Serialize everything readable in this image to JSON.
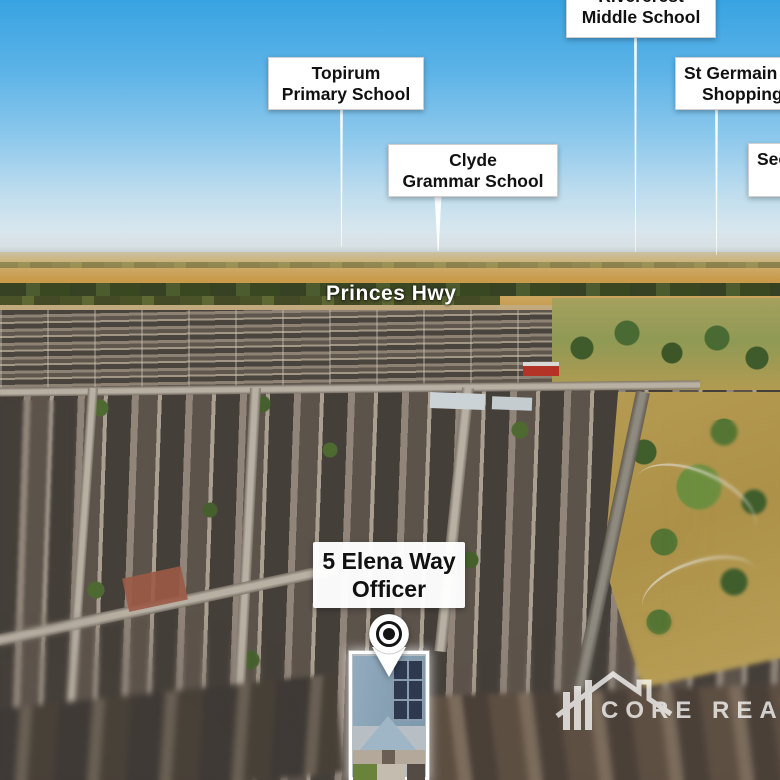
{
  "road_label": "Princes Hwy",
  "poi_labels": {
    "rivercrest": {
      "lines": [
        "Rivercrest",
        "Middle School"
      ]
    },
    "topirum": {
      "lines": [
        "Topirum",
        "Primary School"
      ]
    },
    "clyde": {
      "lines": [
        "Clyde",
        "Grammar School"
      ]
    },
    "st_germain": {
      "lines": [
        "St Germain",
        "Shopping"
      ]
    },
    "secondary": {
      "lines": [
        "Sec"
      ]
    }
  },
  "property_label": {
    "lines": [
      "5 Elena Way",
      "Officer"
    ]
  },
  "watermark": {
    "text": "CORE REAL"
  },
  "icons": {
    "map_pin": "teardrop-location-pin",
    "watermark_house": "house-roofline-with-bars"
  },
  "palette": {
    "sky_top": "#38a3e2",
    "sky_horizon": "#d8e4ea",
    "field_gold": "#c6973f",
    "treeline_green": "#33431f",
    "suburb_roof_dark": "#47413c",
    "road_light": "#b6ad9e",
    "park_grass": "#b59a52",
    "sign_background": "#ffffff",
    "sign_text": "#111111",
    "highlight_outline": "#ffffff",
    "focus_roof_blue": "#8fa6ba",
    "solar_panel": "#2e3950"
  }
}
